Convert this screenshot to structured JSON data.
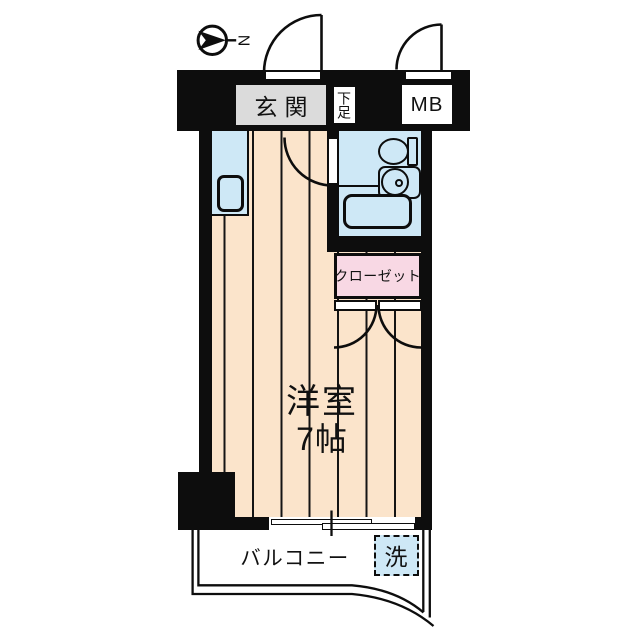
{
  "colors": {
    "wall": "#0d0d0d",
    "line": "#141414",
    "floor": "#fbe4cb",
    "water": "#cee8f6",
    "closet": "#f8d8e4",
    "genkan": "#dbdbdb"
  },
  "compass": {
    "north": "N"
  },
  "entrance": {
    "label": "玄関"
  },
  "shoe_cabinet": {
    "label": "下足"
  },
  "meter_box": {
    "label": "MB"
  },
  "closet": {
    "label": "クローゼット"
  },
  "room": {
    "name": "洋室",
    "size": "7帖"
  },
  "balcony": {
    "label": "バルコニー"
  },
  "laundry": {
    "label": "洗"
  }
}
